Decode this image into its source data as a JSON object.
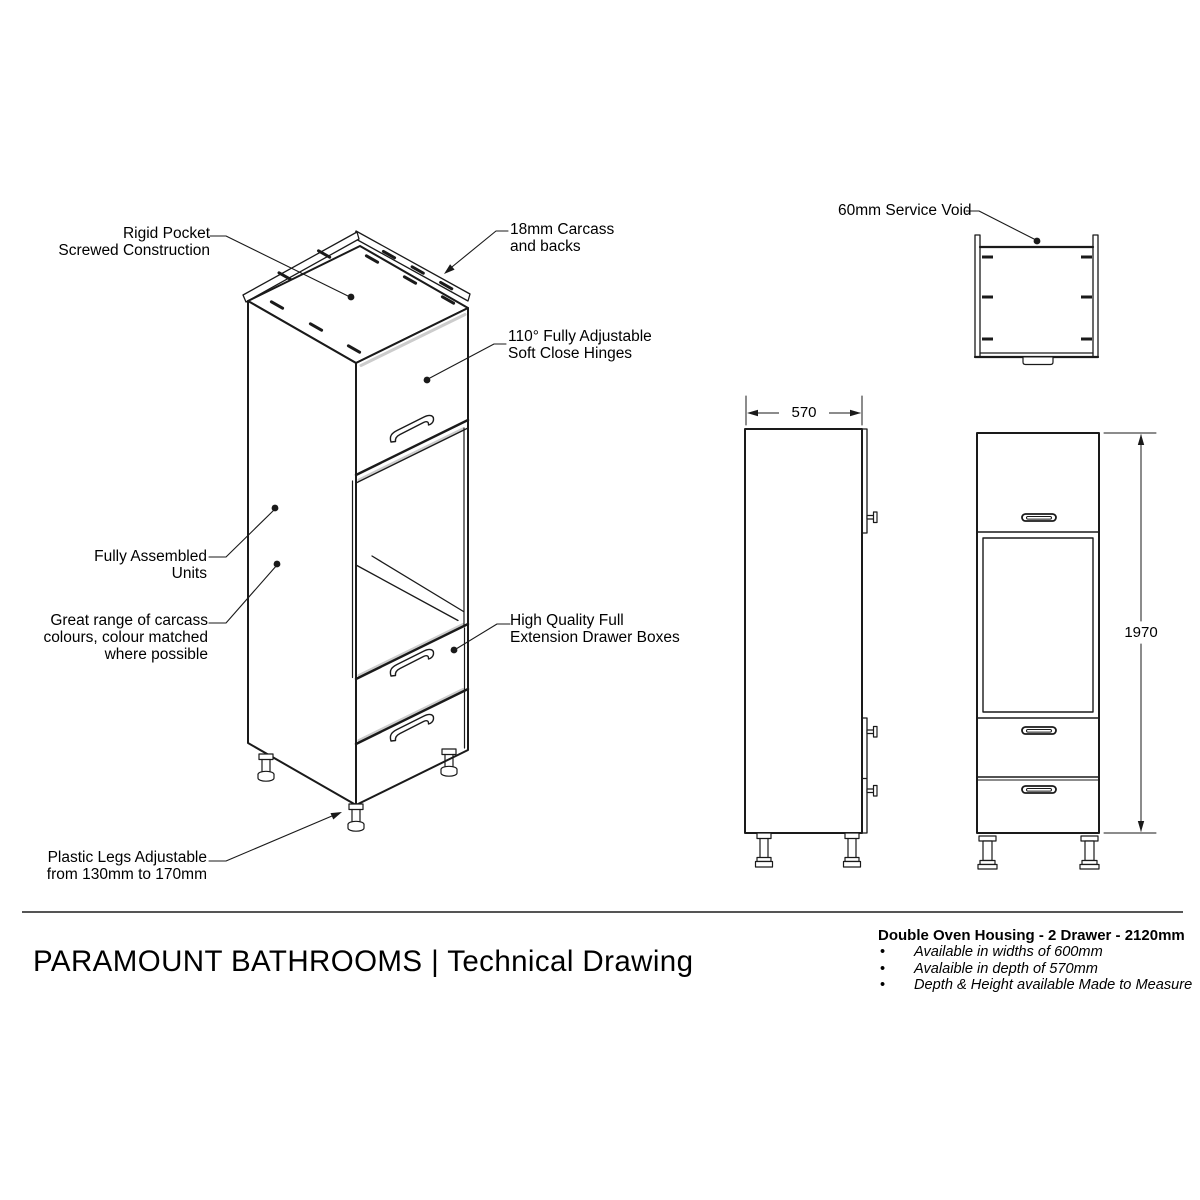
{
  "drawing": {
    "annotations": {
      "rigid_pocket": "Rigid Pocket\nScrewed Construction",
      "carcass_backs": "18mm Carcass\nand backs",
      "hinges": "110° Fully Adjustable\nSoft Close Hinges",
      "fully_assembled": "Fully Assembled\nUnits",
      "carcass_colours": "Great range of carcass\ncolours, colour matched\nwhere possible",
      "drawer_boxes": "High Quality Full\nExtension Drawer Boxes",
      "plastic_legs": "Plastic Legs Adjustable\nfrom 130mm to 170mm",
      "service_void": "60mm Service Void"
    },
    "dimensions": {
      "depth_mm": "570",
      "height_mm": "1970"
    }
  },
  "footer": {
    "title": "PARAMOUNT BATHROOMS | Technical Drawing"
  },
  "product": {
    "name": "Double Oven Housing - 2 Drawer - 2120mm",
    "bullet_char": "•",
    "bullets": [
      "Available in widths of 600mm",
      "Avalaible in depth of 570mm",
      "Depth & Height available Made to Measure"
    ]
  },
  "colors": {
    "line": "#1a1a1a",
    "edge_highlight": "#cccccc",
    "separator": "#555555",
    "background": "#ffffff"
  }
}
